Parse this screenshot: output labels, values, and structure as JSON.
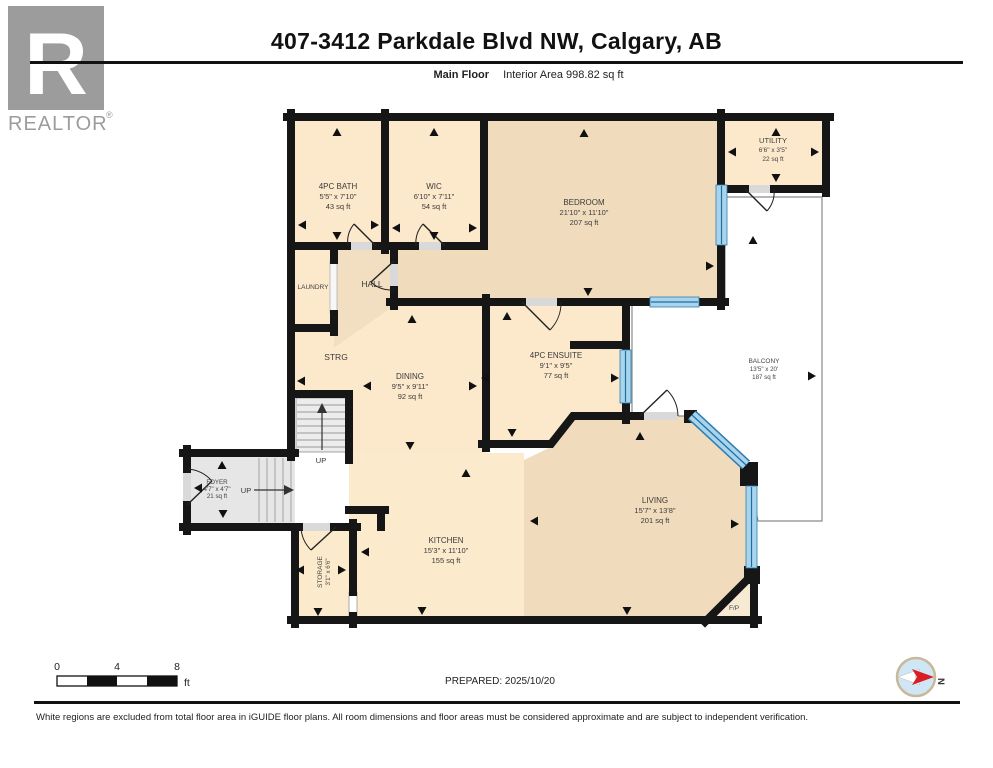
{
  "header": {
    "title": "407-3412 Parkdale Blvd NW, Calgary, AB",
    "floor_label": "Main Floor",
    "area_label": "Interior Area 998.82 sq ft"
  },
  "logo": {
    "letter": "R",
    "wordmark": "REALTOR",
    "reg": "®"
  },
  "rooms": {
    "bath": {
      "name": "4PC BATH",
      "dims": "5'5\" x 7'10\"",
      "area": "43 sq ft"
    },
    "wic": {
      "name": "WIC",
      "dims": "6'10\" x 7'11\"",
      "area": "54 sq ft"
    },
    "bedroom": {
      "name": "BEDROOM",
      "dims": "21'10\" x 11'10\"",
      "area": "207 sq ft"
    },
    "utility": {
      "name": "UTILITY",
      "dims": "6'6\" x 3'5\"",
      "area": "22 sq ft"
    },
    "laundry": {
      "name": "LAUNDRY"
    },
    "hall": {
      "name": "HALL"
    },
    "strg": {
      "name": "STRG"
    },
    "dining": {
      "name": "DINING",
      "dims": "9'5\" x 9'11\"",
      "area": "92 sq ft"
    },
    "ensuite": {
      "name": "4PC ENSUITE",
      "dims": "9'1\" x 9'5\"",
      "area": "77 sq ft"
    },
    "balcony": {
      "name": "BALCONY",
      "dims": "13'5\" x 20'",
      "area": "187 sq ft"
    },
    "foyer": {
      "name": "FOYER",
      "dims": "4'7\" x 4'7\"",
      "area": "21 sq ft"
    },
    "storage": {
      "name": "STORAGE",
      "dims": "3'1\" x 6'6\""
    },
    "kitchen": {
      "name": "KITCHEN",
      "dims": "15'3\" x 11'10\"",
      "area": "155 sq ft"
    },
    "living": {
      "name": "LIVING",
      "dims": "15'7\" x 13'8\"",
      "area": "201 sq ft"
    },
    "fireplace": {
      "name": "F/P"
    },
    "up1": "UP",
    "up2": "UP"
  },
  "scale": {
    "t0": "0",
    "t1": "4",
    "t2": "8",
    "unit": "ft"
  },
  "prepared": "PREPARED: 2025/10/20",
  "compass": {
    "label": "N"
  },
  "footer": {
    "disclaimer": "White regions are excluded from total floor area in iGUIDE floor plans. All room dimensions and floor areas must be considered approximate and are subject to independent verification."
  }
}
